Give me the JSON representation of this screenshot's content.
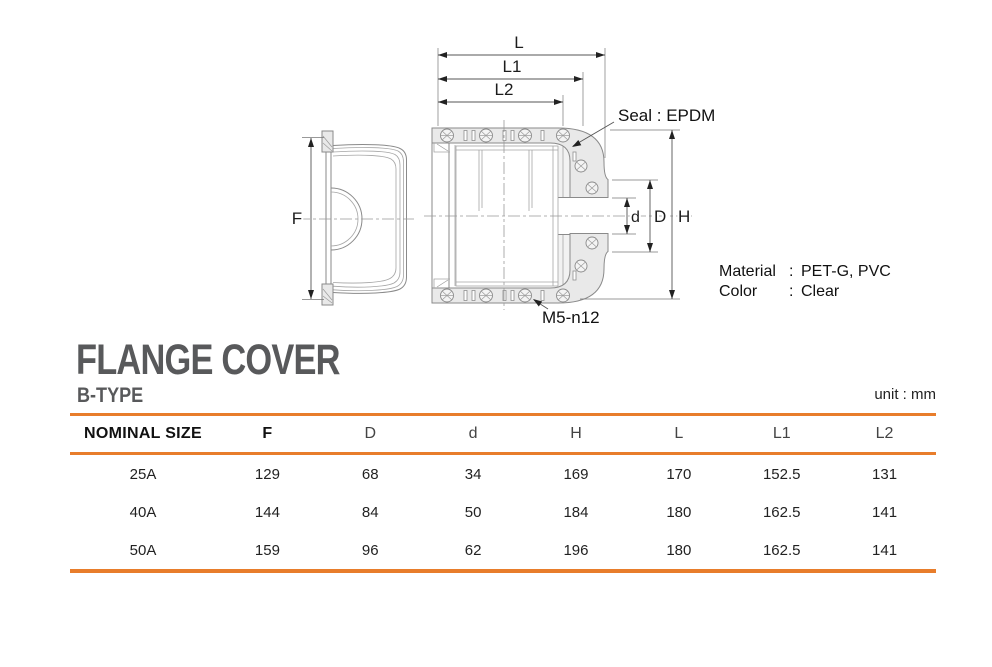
{
  "title": {
    "main": "FLANGE COVER",
    "subtitle": "B-TYPE",
    "unit": "unit : mm"
  },
  "drawing": {
    "dims": {
      "F": "F",
      "L": "L",
      "L1": "L1",
      "L2": "L2",
      "H": "H",
      "D": "D",
      "d": "d"
    },
    "seal_label": "Seal : EPDM",
    "bolt_label": "M5-n12",
    "material": {
      "label": "Material",
      "sep": ":",
      "value": "PET-G, PVC"
    },
    "color": {
      "label": "Color",
      "sep": ":",
      "value": "Clear"
    }
  },
  "table": {
    "headers": [
      "NOMINAL SIZE",
      "F",
      "D",
      "d",
      "H",
      "L",
      "L1",
      "L2"
    ],
    "rows": [
      {
        "size": "25A",
        "values": [
          "129",
          "68",
          "34",
          "169",
          "170",
          "152.5",
          "131"
        ]
      },
      {
        "size": "40A",
        "values": [
          "144",
          "84",
          "50",
          "184",
          "180",
          "162.5",
          "141"
        ]
      },
      {
        "size": "50A",
        "values": [
          "159",
          "96",
          "62",
          "196",
          "180",
          "162.5",
          "141"
        ]
      }
    ]
  },
  "colors": {
    "accent_orange": "#e87d2b",
    "title_gray": "#58595b",
    "line_gray": "#8a8a8a",
    "fill_gray": "#e9e9e9"
  }
}
